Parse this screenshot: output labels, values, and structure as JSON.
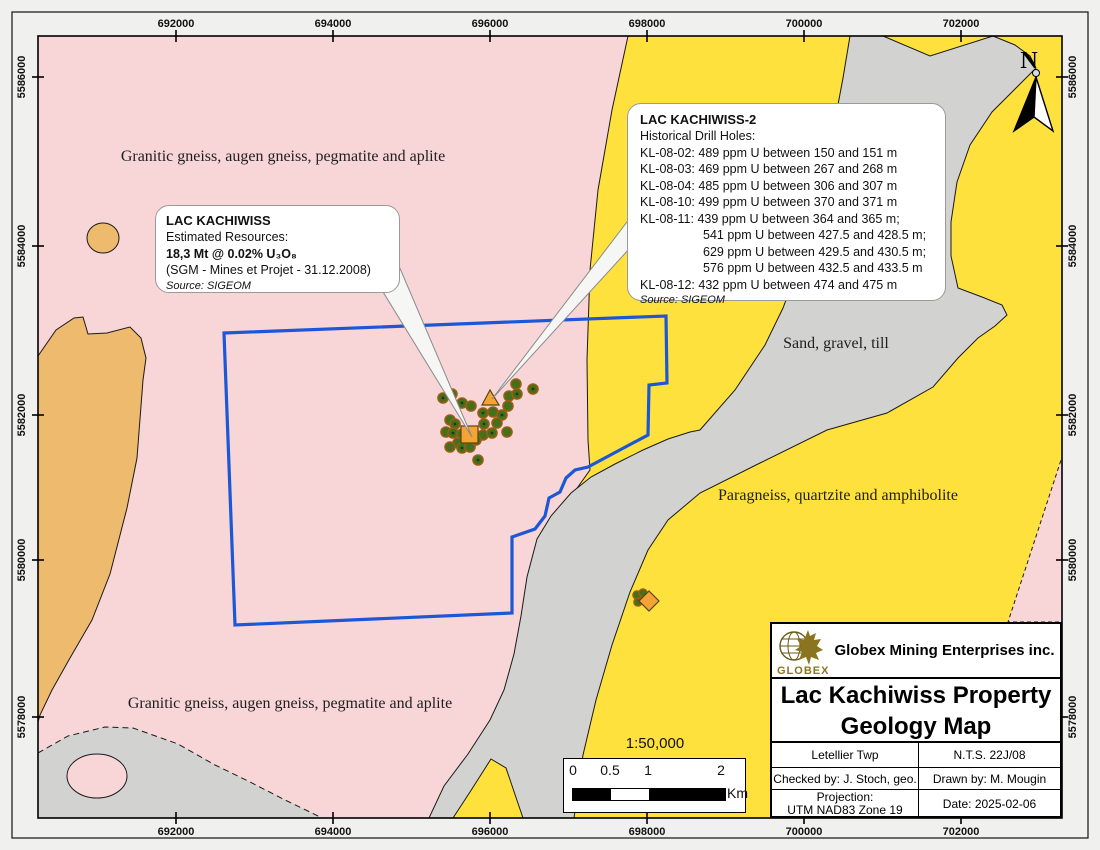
{
  "map": {
    "axis": {
      "x_labels": [
        "692000",
        "694000",
        "696000",
        "698000",
        "700000",
        "702000"
      ],
      "y_labels": [
        "5586000",
        "5584000",
        "5582000",
        "5580000",
        "5578000"
      ]
    },
    "region_labels": {
      "granitic": "Granitic gneiss, augen gneiss, pegmatite and aplite",
      "sand": "Sand, gravel, till",
      "paragneiss": "Paragneiss, quartzite and amphibolite"
    },
    "north_label": "N",
    "scale_ratio": "1:50,000",
    "scale_bar": {
      "t0": "0",
      "t1": "0.5",
      "t2": "1",
      "t3": "2",
      "unit": "Km"
    }
  },
  "callouts": {
    "kachiwiss": {
      "title": "LAC KACHIWISS",
      "line1": "Estimated Resources:",
      "line2": "18,3 Mt @ 0.02% U₃O₈",
      "line3": "(SGM - Mines et Projet - 31.12.2008)",
      "source": "Source: SIGEOM"
    },
    "kachiwiss2": {
      "title": "LAC KACHIWISS-2",
      "subtitle": "Historical Drill Holes:",
      "lines": [
        "KL-08-02: 489 ppm U between 150 and 151 m",
        "KL-08-03: 469 ppm U between 267 and 268 m",
        "KL-08-04: 485 ppm U between 306 and 307 m",
        "KL-08-10: 499 ppm U between 370 and 371 m",
        "KL-08-11: 439 ppm U between 364 and 365 m;",
        "541 ppm U between 427.5 and 428.5 m;",
        "629 ppm U between 429.5 and 430.5 m;",
        "576 ppm U between 432.5 and 433.5 m",
        "KL-08-12: 432 ppm U between 474 and 475 m"
      ],
      "source": "Source: SIGEOM"
    }
  },
  "title_block": {
    "logo_text": "GLOBEX",
    "company": "Globex Mining Enterprises inc.",
    "title_line1": "Lac Kachiwiss Property",
    "title_line2": "Geology Map",
    "township": "Letellier Twp",
    "nts": "N.T.S. 22J/08",
    "checked_by": "Checked by: J. Stoch, geo.",
    "drawn_by": "Drawn by: M. Mougin",
    "projection_label": "Projection:",
    "projection_value": "UTM NAD83 Zone 19",
    "date": "Date: 2025-02-06"
  },
  "colors": {
    "pink_granitic": "#F8D5D7",
    "yellow_paragneiss": "#FFE13D",
    "gray_till": "#D2D2D0",
    "orange_unit": "#EDBA6E",
    "blue_boundary": "#1B57D6",
    "marker_orange": "#F5A433",
    "dot_green": "#44701C",
    "logo_gold": "#8A7420"
  }
}
